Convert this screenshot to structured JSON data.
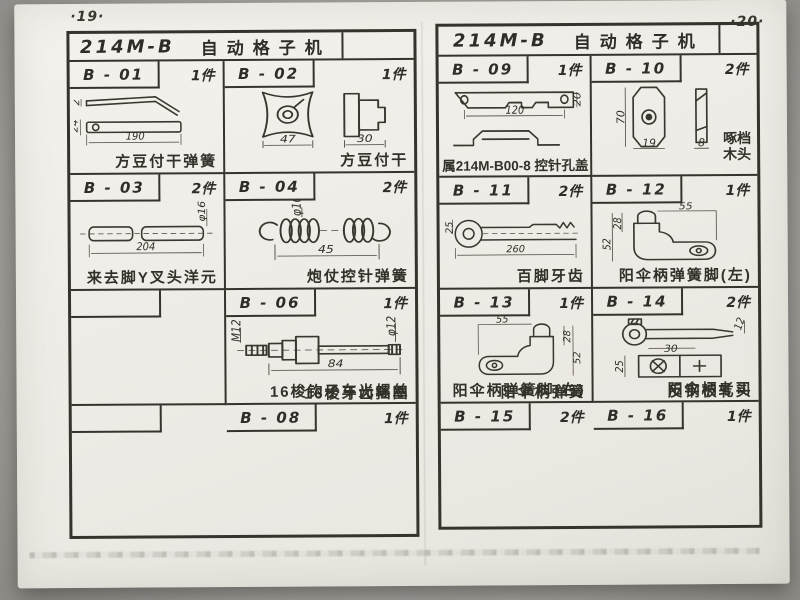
{
  "photo": {
    "paper_color": "#eeece6",
    "ink_color": "#35332c",
    "background_color": "#a19f9b"
  },
  "pages": [
    {
      "page_number": "·19·",
      "header": {
        "model": "214M-B",
        "title": "自动格子机"
      },
      "cells": [
        {
          "id": "B - 01",
          "qty": "1件",
          "caption": "方豆付干弹簧",
          "dims": {
            "d1": "2",
            "d2": "24",
            "d3": "190"
          }
        },
        {
          "id": "B - 02",
          "qty": "1件",
          "caption": "方豆付干",
          "dims": {
            "d1": "47",
            "d2": "30"
          }
        },
        {
          "id": "B - 03",
          "qty": "2件",
          "caption": "来去脚Y叉头洋元",
          "dims": {
            "d1": "φ16",
            "d2": "204"
          }
        },
        {
          "id": "B - 04",
          "qty": "2件",
          "caption": "炮仗控针弹簧",
          "dims": {
            "d1": "φ10",
            "d2": "45"
          }
        },
        {
          "id": "",
          "qty": "",
          "caption": ""
        },
        {
          "id": "B - 06",
          "qty": "1件",
          "caption": "16梭钩子车光螺丝",
          "dims": {
            "d1": "M12",
            "d2": "84",
            "d3": "φ12"
          }
        },
        {
          "id": "",
          "qty": "",
          "caption": ""
        },
        {
          "id": "B - 08",
          "qty": "1件",
          "caption": "16梭牙齿挡圈",
          "dims": {
            "d1": "φ75",
            "d2": "4"
          }
        }
      ]
    },
    {
      "page_number": "·20·",
      "header": {
        "model": "214M-B",
        "title": "自动格子机"
      },
      "cells": [
        {
          "id": "B - 09",
          "qty": "1件",
          "caption": "属214M-B00-8 控针孔盖",
          "dims": {
            "d1": "120",
            "d2": "20"
          }
        },
        {
          "id": "B - 10",
          "qty": "2件",
          "caption": "啄档木头",
          "dims": {
            "d1": "70",
            "d2": "19",
            "d3": "8"
          }
        },
        {
          "id": "B - 11",
          "qty": "2件",
          "caption": "百脚牙齿",
          "dims": {
            "d1": "25",
            "d2": "260"
          }
        },
        {
          "id": "B - 12",
          "qty": "1件",
          "caption": "阳伞柄弹簧脚(左)",
          "dims": {
            "d1": "55",
            "d2": "28",
            "d3": "52"
          }
        },
        {
          "id": "B - 13",
          "qty": "1件",
          "caption": "阳伞柄弹簧脚(右)",
          "dims": {
            "d1": "55",
            "d2": "28",
            "d3": "52"
          }
        },
        {
          "id": "B - 14",
          "qty": "2件",
          "caption": "阳伞柄考司",
          "dims": {
            "d1": "12",
            "d2": "30",
            "d3": "25"
          }
        },
        {
          "id": "B - 15",
          "qty": "2件",
          "caption": "阳伞柄弹簧",
          "dims": {
            "d1": "230",
            "d2": "25"
          }
        },
        {
          "id": "B - 16",
          "qty": "1件",
          "caption": "反钢板轧头",
          "dims": {
            "d1": "38",
            "d2": "25"
          }
        }
      ]
    }
  ]
}
